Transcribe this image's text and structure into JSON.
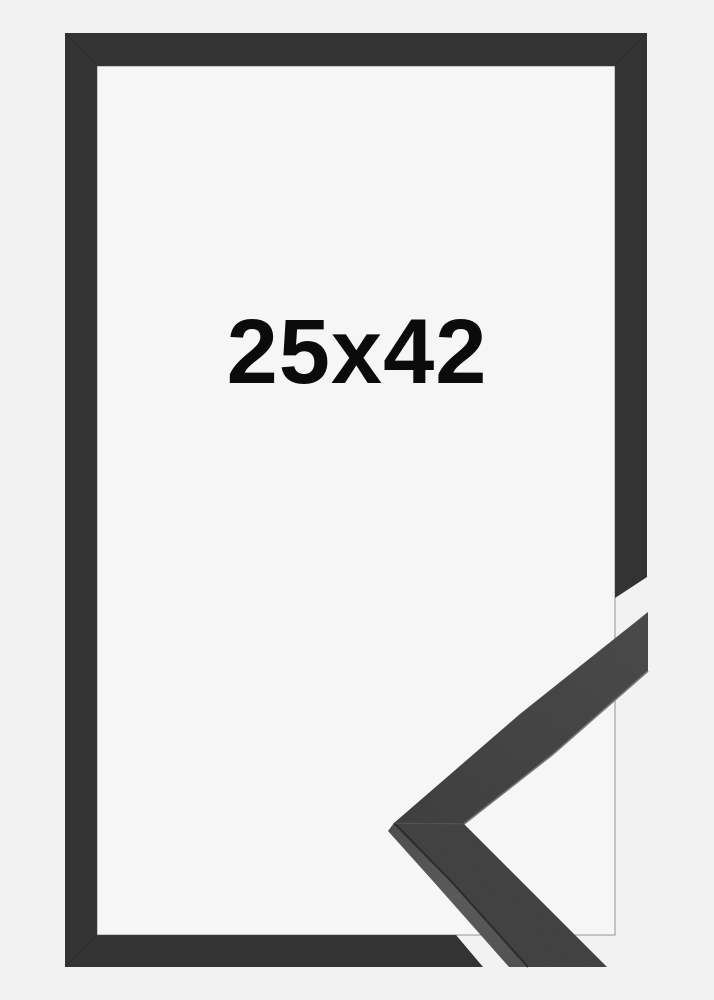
{
  "product": {
    "size_label": "25x42",
    "description": "black picture frame product photo with mitered corner profile detail"
  },
  "icons": {
    "corner_sample": "frame-corner-profile"
  },
  "colors": {
    "background": "#f2f2f3",
    "interior": "#f6f6f7",
    "frame": "#333333",
    "sample_face": "#3e3e3e",
    "sample_face_end": "#474747",
    "sample_side": "#555555",
    "sample_edge_dark": "#242424",
    "sample_edge_light": "#6d6d6d",
    "text": "#0b0b0b"
  }
}
